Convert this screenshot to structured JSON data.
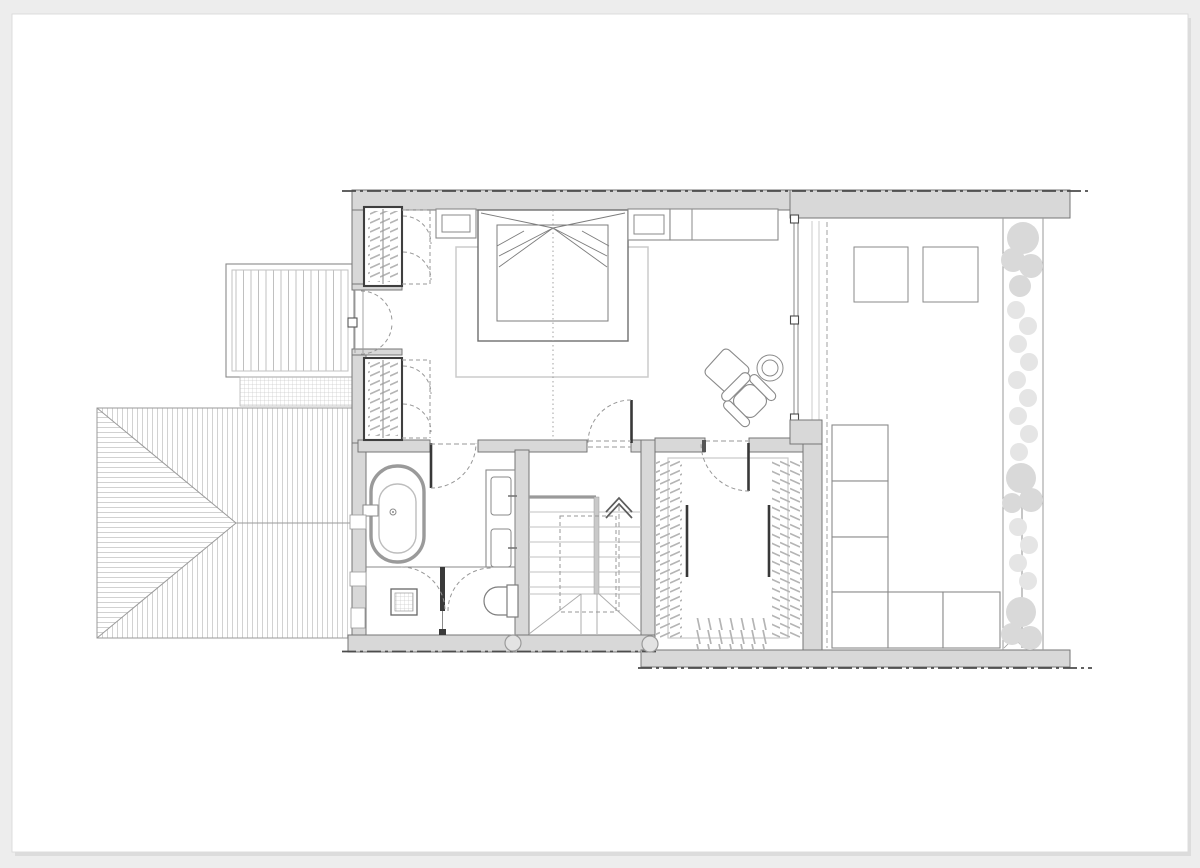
{
  "document": {
    "kind": "architectural floor plan drawing",
    "visible_text": "",
    "sheet": "white sheet on light grey backdrop"
  },
  "colors": {
    "bg": "#ededed",
    "paper": "#ffffff",
    "wall": "#d8d8d8",
    "wallEdge": "#767676",
    "line": "#979797",
    "lineLight": "#c2c2c2",
    "lineDark": "#383838",
    "furn": "#8a8a8a",
    "dash": "#4c4c4c",
    "rug": "#cbcbcb",
    "hatch": "#c6c6c6",
    "plant": "#d9d9d9",
    "plantFaint": "#e5e5e5"
  },
  "plan": {
    "rooms": [
      {
        "name": "bedroom"
      },
      {
        "name": "bathroom"
      },
      {
        "name": "stair-hall"
      },
      {
        "name": "walk-in-closet"
      },
      {
        "name": "roof-terrace"
      },
      {
        "name": "balcony-deck"
      },
      {
        "name": "hipped-roof"
      }
    ],
    "fixtures": [
      "double-bed",
      "rug",
      "nightstand-left",
      "nightstand-right",
      "dresser",
      "wardrobe-upper",
      "wardrobe-lower",
      "french-door",
      "pouf",
      "armchair",
      "side-table",
      "bathtub",
      "double-vanity",
      "shower-drain",
      "toilet",
      "staircase",
      "up-arrow",
      "hanging-rails",
      "skylight-1",
      "skylight-2",
      "sofa-modules",
      "planter-hedge",
      "downpipes"
    ]
  }
}
